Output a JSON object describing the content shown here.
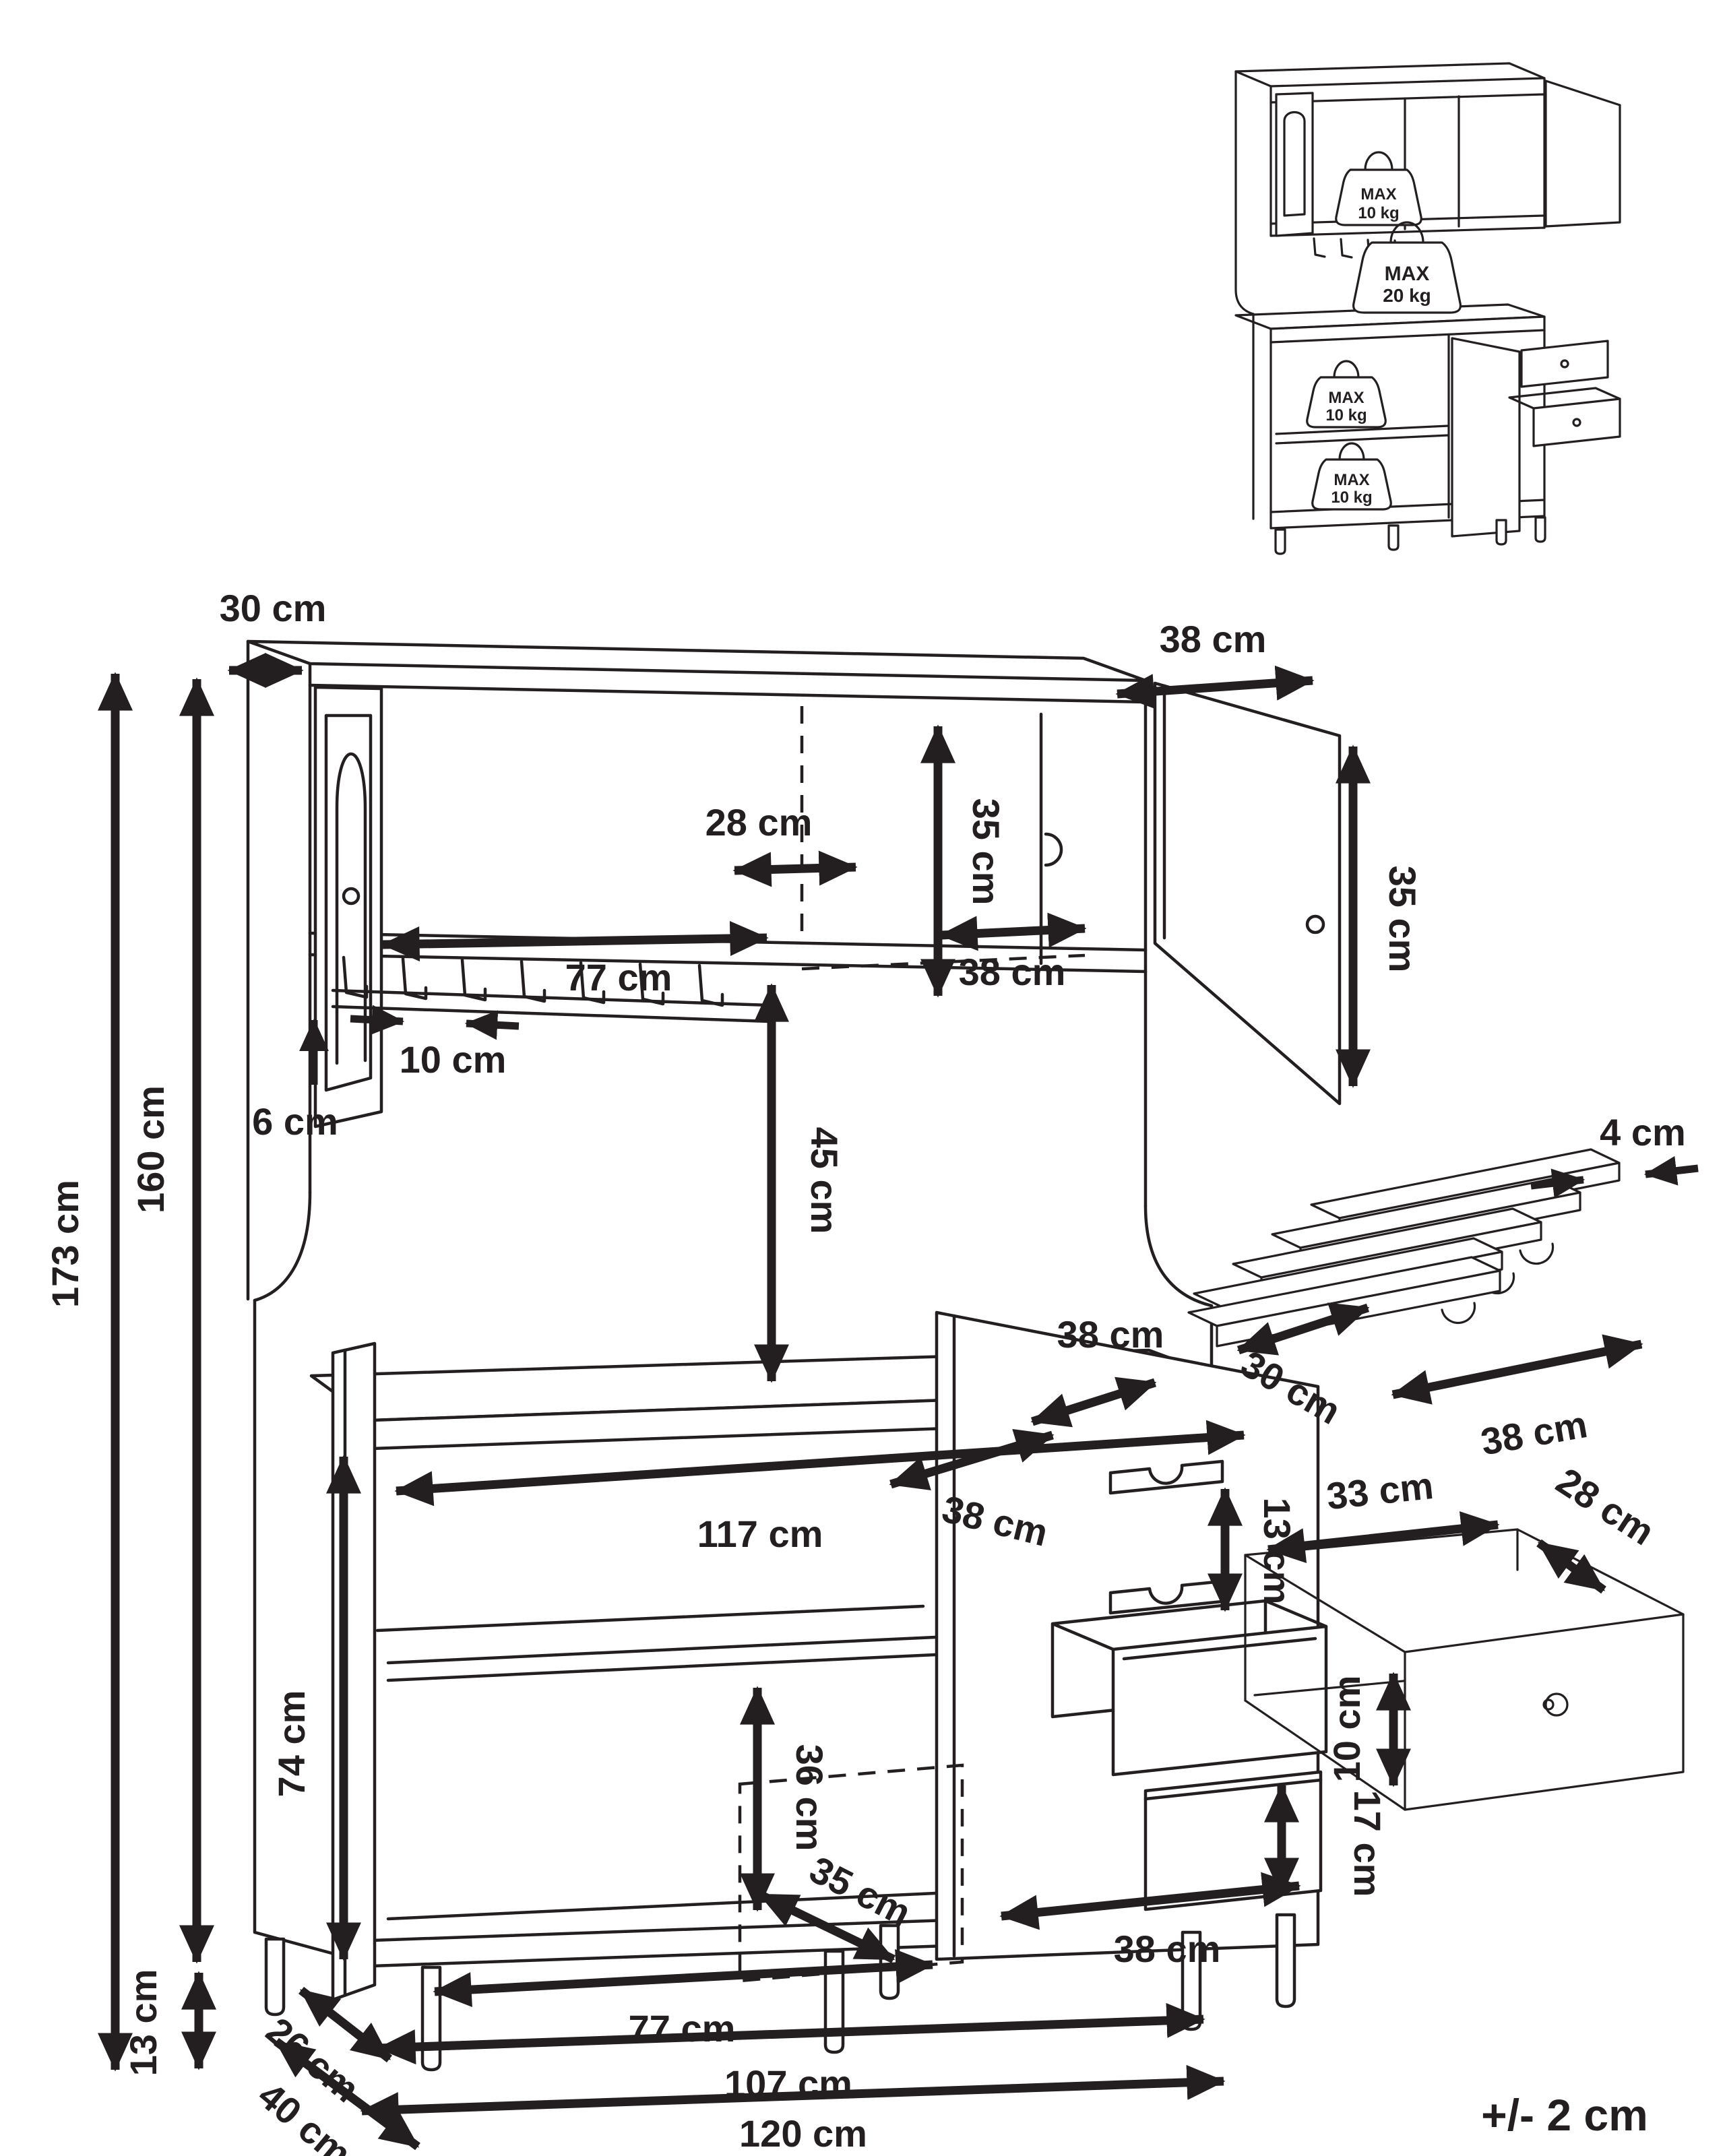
{
  "tolerance_note": "+/- 2 cm",
  "inset": {
    "weights": [
      {
        "line1": "MAX",
        "line2": "10 kg"
      },
      {
        "line1": "MAX",
        "line2": "20 kg"
      },
      {
        "line1": "MAX",
        "line2": "10 kg"
      },
      {
        "line1": "MAX",
        "line2": "10 kg"
      }
    ]
  },
  "dims": {
    "top_depth": "30 cm",
    "total_height": "173 cm",
    "hutch_height": "160 cm",
    "top_door_width": "38 cm",
    "top_interior_height": "35 cm",
    "top_door_height": "35 cm",
    "top_inner_width": "28 cm",
    "glass_rack_width": "77 cm",
    "top_middle_door_width": "38 cm",
    "glass_slot_width": "10 cm",
    "glass_rack_height": "6 cm",
    "open_shelf_height": "45 cm",
    "counter_depth": "38 cm",
    "counter_width": "117 cm",
    "lower_door_width": "38 cm",
    "bottle_rack_pitch": "13 cm",
    "lower_height": "74 cm",
    "lower_interior_height": "36 cm",
    "lower_interior_depth": "35 cm",
    "drawer_front_height": "17 cm",
    "drawer_bay_width": "38 cm",
    "leg_height": "13 cm",
    "inner_depth": "26 cm",
    "total_depth": "40 cm",
    "lower_interior_width": "77 cm",
    "inner_width": "107 cm",
    "total_width": "120 cm"
  },
  "wine_rack_detail": {
    "slat_width": "4 cm",
    "depth": "30 cm",
    "width": "38 cm"
  },
  "drawer_detail": {
    "width": "33 cm",
    "depth": "28 cm",
    "height": "10 cm"
  }
}
